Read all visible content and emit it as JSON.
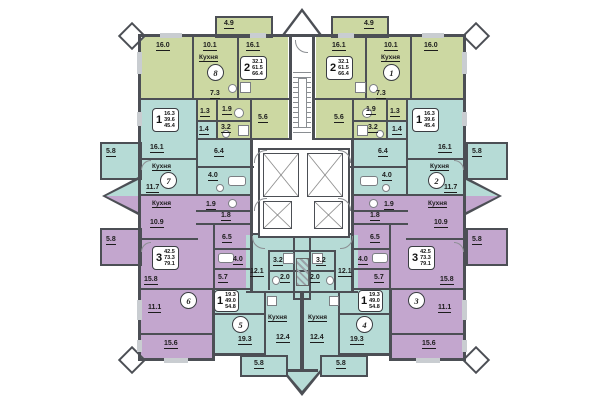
{
  "plan": {
    "kitchen_label": "Кухня",
    "colors": {
      "green_zone": "#ccd8a2",
      "teal_zone": "#b6dbd6",
      "purple_zone": "#c3a6ce",
      "wall": "#4c4f55",
      "window": "#c9cdd1"
    },
    "apartments": {
      "apt8": {
        "number": "8",
        "type_card": {
          "rooms": "2",
          "living_area": "32.1",
          "floor_area": "61.5",
          "total_area": "66.4"
        },
        "areas": {
          "room1": "16.0",
          "kitchen": "10.1",
          "room2": "16.1",
          "hall": "7.3",
          "wc": "1.3",
          "bath": "1.9",
          "bath2": "3.2",
          "storage": "5.6",
          "balcony": "4.9"
        }
      },
      "apt1": {
        "number": "1",
        "type_card": {
          "rooms": "2",
          "living_area": "32.1",
          "floor_area": "61.5",
          "total_area": "66.4"
        },
        "areas": {
          "room1": "16.0",
          "kitchen": "10.1",
          "room2": "16.1",
          "hall": "7.3",
          "wc": "1.3",
          "bath": "1.9",
          "bath2": "3.2",
          "storage": "5.6",
          "balcony": "4.9"
        }
      },
      "apt7": {
        "number": "7",
        "type_card": {
          "rooms": "1",
          "living_area": "16.3",
          "floor_area": "39.6",
          "total_area": "45.4"
        },
        "areas": {
          "room": "16.1",
          "kitchen": "11.7",
          "hall": "6.4",
          "bath": "4.0",
          "storage": "1.4",
          "balcony": "5.8"
        }
      },
      "apt2": {
        "number": "2",
        "type_card": {
          "rooms": "1",
          "living_area": "16.3",
          "floor_area": "39.6",
          "total_area": "45.4"
        },
        "areas": {
          "room": "16.1",
          "kitchen": "11.7",
          "hall": "6.4",
          "bath": "4.0",
          "storage": "1.4",
          "balcony": "5.8"
        }
      },
      "apt6": {
        "number": "6",
        "type_card": {
          "rooms": "3",
          "living_area": "42.5",
          "floor_area": "73.3",
          "total_area": "79.1"
        },
        "areas": {
          "kitchen": "10.9",
          "wc": "1.9",
          "storage": "1.8",
          "hall": "6.5",
          "bath": "4.0",
          "corridor": "5.7",
          "room1": "15.8",
          "room2": "11.1",
          "room3": "15.6",
          "balcony": "5.8"
        }
      },
      "apt3": {
        "number": "3",
        "type_card": {
          "rooms": "3",
          "living_area": "42.5",
          "floor_area": "73.3",
          "total_area": "79.1"
        },
        "areas": {
          "kitchen": "10.9",
          "wc": "1.9",
          "storage": "1.8",
          "hall": "6.5",
          "bath": "4.0",
          "corridor": "5.7",
          "room1": "15.8",
          "room2": "11.1",
          "room3": "15.6",
          "balcony": "5.8"
        }
      },
      "apt5": {
        "number": "5",
        "type_card": {
          "rooms": "1",
          "living_area": "19.3",
          "floor_area": "49.0",
          "total_area": "54.8"
        },
        "areas": {
          "hall": "12.1",
          "bath": "3.2",
          "wc": "2.0",
          "room": "19.3",
          "kitchen": "12.4",
          "balcony": "5.8"
        }
      },
      "apt4": {
        "number": "4",
        "type_card": {
          "rooms": "1",
          "living_area": "19.3",
          "floor_area": "49.0",
          "total_area": "54.8"
        },
        "areas": {
          "hall": "12.1",
          "bath": "3.2",
          "wc": "2.0",
          "room": "19.3",
          "kitchen": "12.4",
          "balcony": "5.8"
        }
      }
    }
  }
}
